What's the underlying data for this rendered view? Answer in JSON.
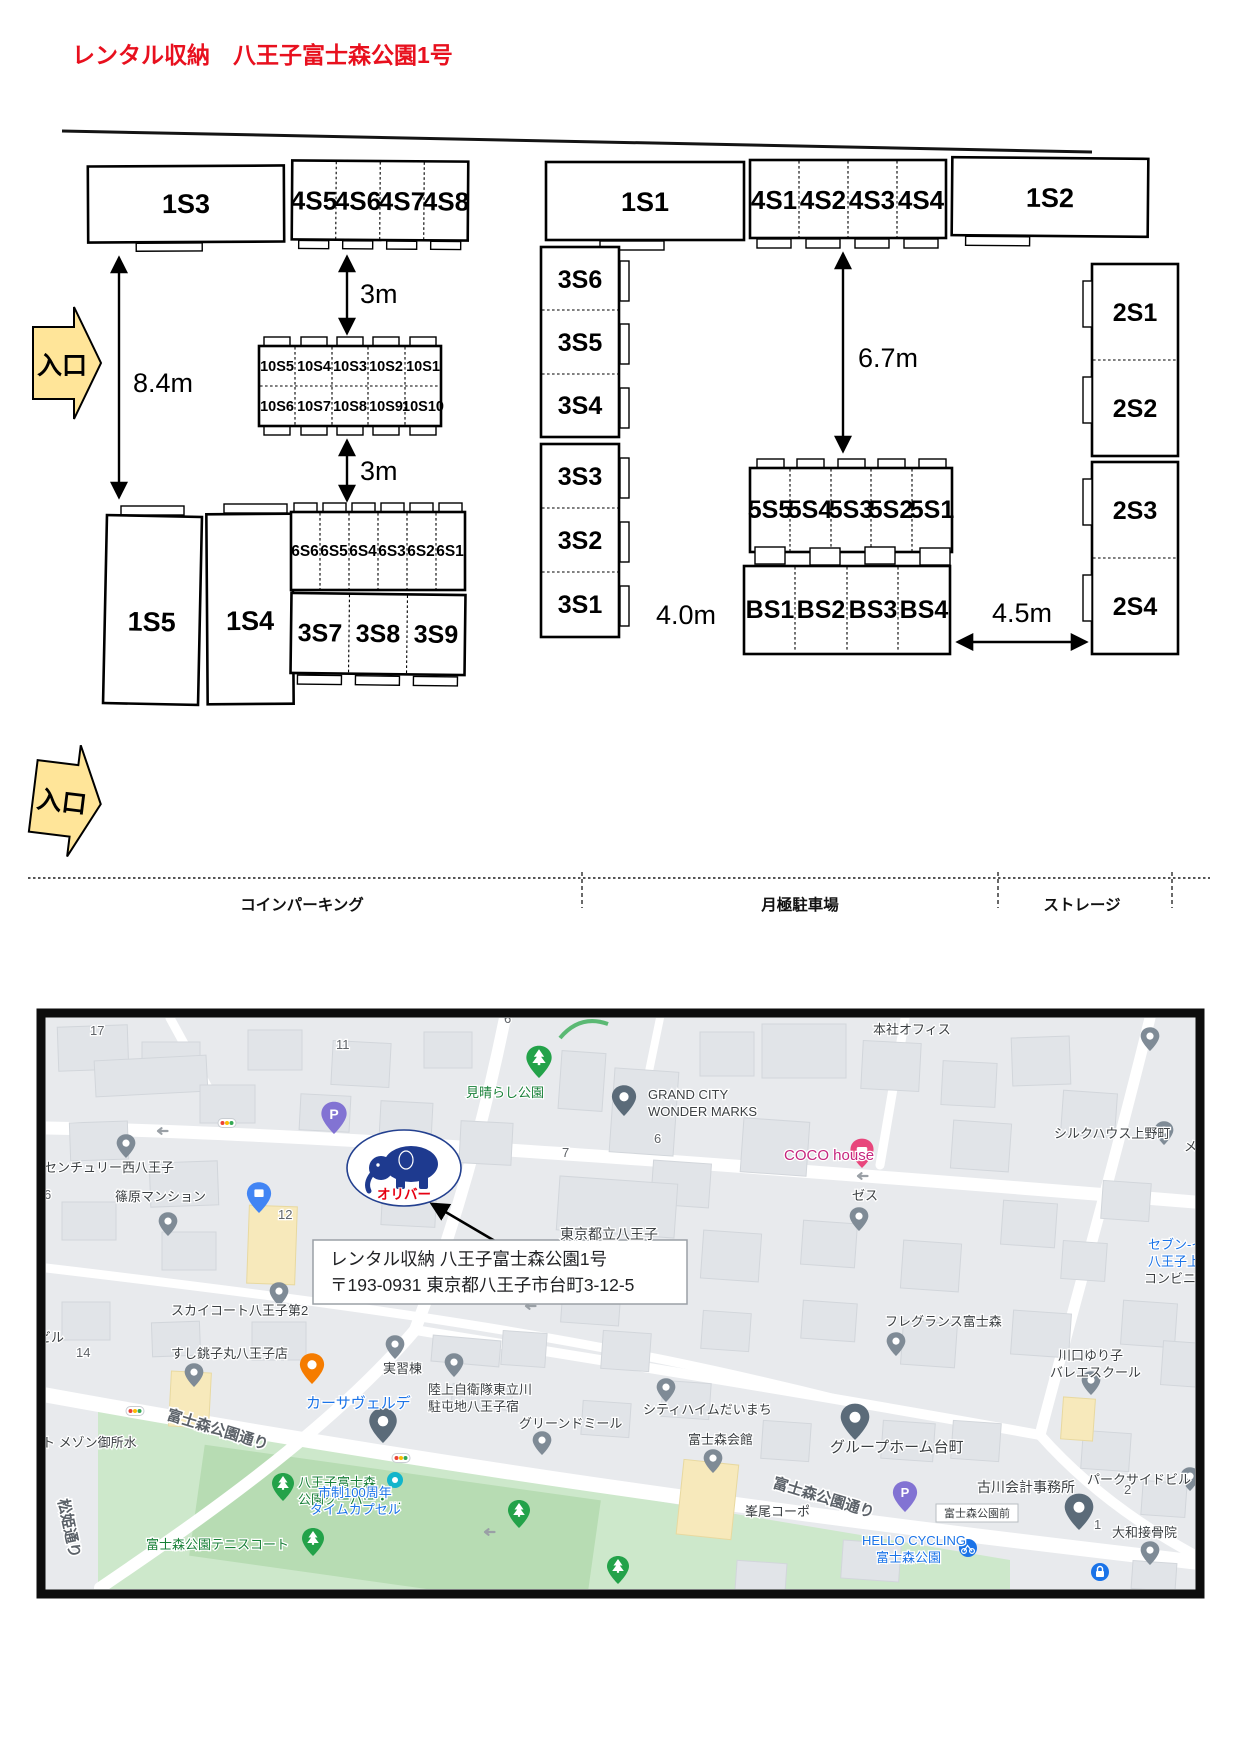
{
  "title": "レンタル収納　八王子富士森公園1号",
  "plan": {
    "entrance": "入口",
    "m": {
      "v3": "3m",
      "v84": "8.4m",
      "v67": "6.7m",
      "v40": "4.0m",
      "v45": "4.5m"
    },
    "u": {
      "s1_1": "1S1",
      "s1_2": "1S2",
      "s1_3": "1S3",
      "s1_4": "1S4",
      "s1_5": "1S5",
      "s2_1": "2S1",
      "s2_2": "2S2",
      "s2_3": "2S3",
      "s2_4": "2S4",
      "s3_1": "3S1",
      "s3_2": "3S2",
      "s3_3": "3S3",
      "s3_4": "3S4",
      "s3_5": "3S5",
      "s3_6": "3S6",
      "s3_7": "3S7",
      "s3_8": "3S8",
      "s3_9": "3S9",
      "s4_1": "4S1",
      "s4_2": "4S2",
      "s4_3": "4S3",
      "s4_4": "4S4",
      "s4_5": "4S5",
      "s4_6": "4S6",
      "s4_7": "4S7",
      "s4_8": "4S8",
      "s5_1": "5S1",
      "s5_2": "5S2",
      "s5_3": "5S3",
      "s5_4": "5S4",
      "s5_5": "5S5",
      "s6_1": "6S1",
      "s6_2": "6S2",
      "s6_3": "6S3",
      "s6_4": "6S4",
      "s6_5": "6S5",
      "s6_6": "6S6",
      "s10_1": "10S1",
      "s10_2": "10S2",
      "s10_3": "10S3",
      "s10_4": "10S4",
      "s10_5": "10S5",
      "s10_6": "10S6",
      "s10_7": "10S7",
      "s10_8": "10S8",
      "s10_9": "10S9",
      "s10_10": "10S10",
      "b1": "BS1",
      "b2": "BS2",
      "b3": "BS3",
      "b4": "BS4"
    },
    "strip": {
      "coin": "コインパーキング",
      "monthly": "月極駐車場",
      "storage": "ストレージ"
    }
  },
  "map": {
    "callout1": "レンタル収納 八王子富士森公園1号",
    "callout2": "〒193-0931  東京都八王子市台町3-12-5",
    "logo": "オリバー",
    "p": "P",
    "l": {
      "miharashi": "見晴らし公園",
      "honsha": "本社オフィス",
      "grand1": "GRAND CITY",
      "grand2": "WONDER MARKS",
      "coco": "COCO house",
      "zesu": "ゼス",
      "silk": "シルクハウス上野町",
      "mezo": "メゾ",
      "seven1": "セブン-イレ",
      "seven2": "八王子上野",
      "seven3": "コンビニエンスス",
      "century": "センチュリー西八王子",
      "shino": "篠原マンション",
      "tokyo": "東京都立八王子",
      "sky": "スカイコート八王子第2",
      "fragrance": "フレグランス富士森",
      "sushi": "すし銚子丸八王子店",
      "jisshu": "実習棟",
      "casa": "カーサヴェルデ",
      "riku1": "陸上自衛隊東立川",
      "riku2": "駐屯地八王子宿",
      "greend": "グリーンドミール",
      "cityheim": "シティハイムだいまち",
      "kaikan": "富士森会館",
      "ghome": "グループホーム台町",
      "kawa1": "川口ゆり子",
      "kawa2": "バレエスクール",
      "furukawa": "古川会計事務所",
      "parkside": "パークサイドビル",
      "yamato": "大和接骨院",
      "mineo": "峯尾コーポ",
      "mezon": "ト メゾン御所水",
      "biru": "ビル",
      "fujidori": "富士森公園通り",
      "matsu": "松姫通り",
      "kuper1": "八王子富士森",
      "kuper2": "公園クーパー・…",
      "tennis": "富士森公園テニスコート",
      "shisei1": "市制100周年",
      "shisei2": "タイムカプセル",
      "hello1": "HELLO CYCLING",
      "hello2": "富士森公園",
      "fujimae": "富士森公園前"
    },
    "n": {
      "n17": "17",
      "n11": "11",
      "n12": "12",
      "n6a": "6",
      "n6b": "6",
      "n6c": "6",
      "n7": "7",
      "n14": "14",
      "n2": "2",
      "n1": "1"
    }
  }
}
